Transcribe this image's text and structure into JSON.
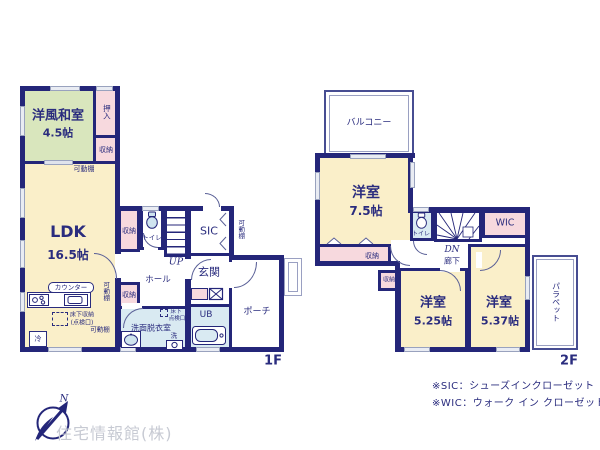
{
  "colors": {
    "wall": "#242679",
    "ink": "#2a2c7e",
    "yellow": "#faefc9",
    "green": "#d9e6bd",
    "pink": "#f7d9de",
    "blue": "#d9eaf2"
  },
  "shared": {
    "closet": "収納",
    "shelf": "可動棚",
    "toilet": "トイレ"
  },
  "floor1": {
    "label": "1F",
    "washitsu_name": "洋風和室",
    "washitsu_size": "4.5帖",
    "oshiire": "押入",
    "ldk_name": "LDK",
    "ldk_size": "16.5帖",
    "counter": "カウンター",
    "underfloor_storage": "床下収納",
    "underfloor_storage_sub": "(点検口)",
    "fridge": "冷",
    "up": "UP",
    "hall": "ホール",
    "sic": "SIC",
    "genkan": "玄関",
    "porch": "ポーチ",
    "senmen": "洗面脱衣室",
    "hatch_line1": "床下",
    "hatch_line2": "点検口",
    "washer": "洗",
    "ub": "UB"
  },
  "floor2": {
    "label": "2F",
    "balcony": "バルコニー",
    "room_name": "洋室",
    "room75_size": "7.5帖",
    "room525_size": "5.25帖",
    "room537_size": "5.37帖",
    "dn": "DN",
    "corridor": "廊下",
    "wic": "WIC",
    "parapet": "パラペット"
  },
  "notes": {
    "sic": "※SIC：シューズインクローゼット",
    "wic": "※WIC：ウォーク イン クローゼット"
  },
  "logo": {
    "company": "住宅情報館(株)",
    "north": "N"
  }
}
